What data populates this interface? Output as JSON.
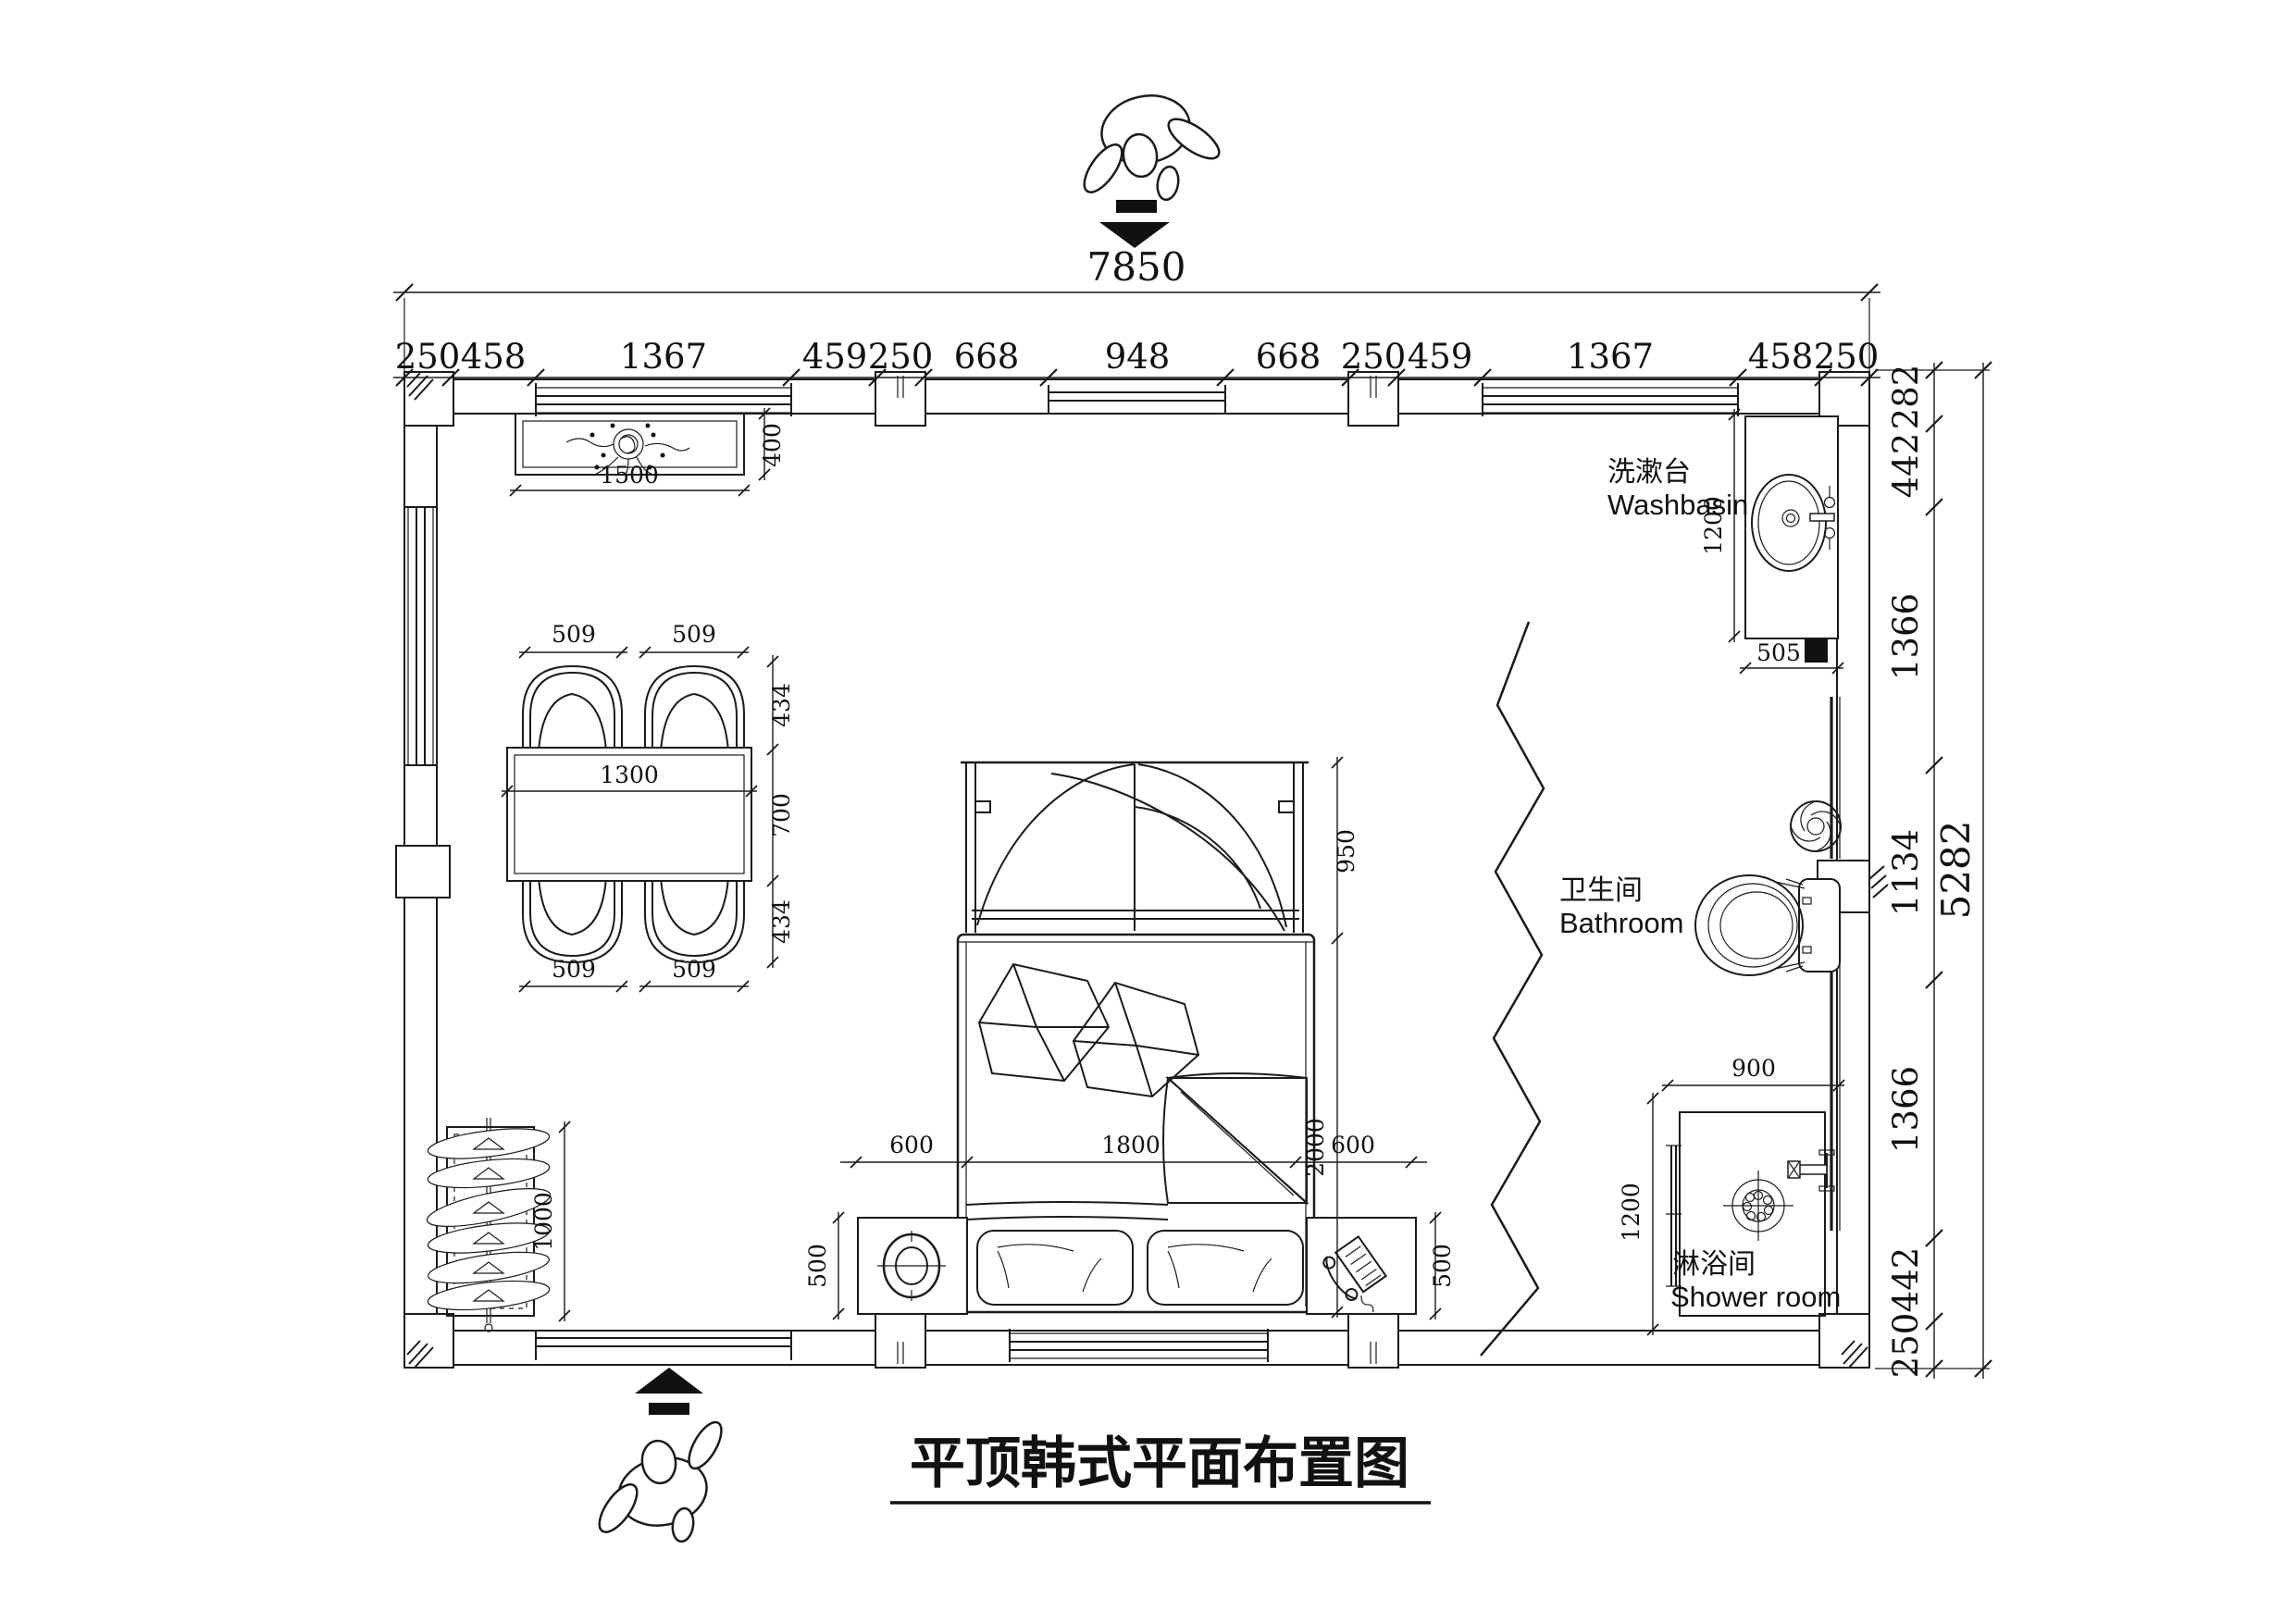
{
  "title": "平顶韩式平面布置图",
  "rooms": {
    "washbasin": {
      "zh": "洗漱台",
      "en": "Washbasin"
    },
    "bathroom": {
      "zh": "卫生间",
      "en": "Bathroom"
    },
    "shower": {
      "zh": "淋浴间",
      "en": "Shower room"
    }
  },
  "dims": {
    "top_total": "7850",
    "top": [
      "250",
      "458",
      "1367",
      "459",
      "250",
      "668",
      "948",
      "668",
      "250",
      "459",
      "1367",
      "458",
      "250"
    ],
    "right_total": "5282",
    "right": [
      "282",
      "442",
      "1366",
      "1134",
      "1366",
      "442",
      "250"
    ],
    "light": [
      "1500",
      "400"
    ],
    "dining_top": [
      "509",
      "509"
    ],
    "dining_bottom": [
      "509",
      "509"
    ],
    "dining_side": [
      "434",
      "700",
      "434"
    ],
    "table": "1300",
    "bed_canopy": "950",
    "bed_length": "2000",
    "bed_row": [
      "600",
      "1800",
      "600"
    ],
    "nightstands": [
      "500",
      "500"
    ],
    "wardrobe": "1000",
    "washbasin_dims": [
      "1200",
      "505"
    ],
    "shower_dims": [
      "900",
      "1200"
    ]
  },
  "colors": {
    "line": "#1b1b1b",
    "background": "#ffffff"
  }
}
